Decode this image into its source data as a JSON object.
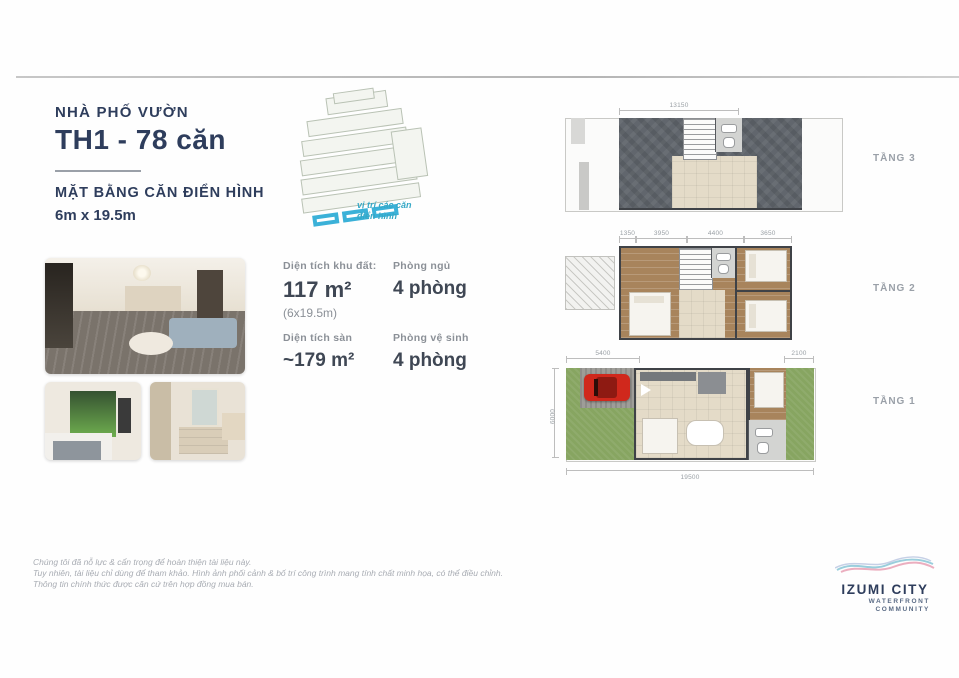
{
  "header": {
    "project_type": "NHÀ PHỐ VƯỜN",
    "unit_title": "TH1 - 78 căn",
    "subtitle": "MẶT BẰNG CĂN ĐIỂN HÌNH",
    "lot_size": "6m x 19.5m"
  },
  "sitemap": {
    "caption_line1": "vị trí các căn",
    "caption_line2": "điển hình"
  },
  "specs": {
    "land_area_label": "Diện tích khu đất:",
    "land_area_value": "117 m²",
    "land_area_note": "(6x19.5m)",
    "bedrooms_label": "Phòng ngủ",
    "bedrooms_value": "4 phòng",
    "floor_area_label": "Diện tích sàn",
    "floor_area_value": "~179 m²",
    "bathrooms_label": "Phòng vệ sinh",
    "bathrooms_value": "4 phòng"
  },
  "floorplans": {
    "floor3": {
      "label": "TẦNG 3",
      "dim_top": "13150"
    },
    "floor2": {
      "label": "TẦNG 2",
      "dims": [
        "1350",
        "3950",
        "4400",
        "3650"
      ]
    },
    "floor1": {
      "label": "TẦNG 1",
      "dim_front": "5400",
      "dim_back": "2100",
      "dim_length": "19500",
      "dim_width": "6000"
    }
  },
  "disclaimer": {
    "line1": "Chúng tôi đã nỗ lực & cẩn trọng để hoàn thiện tài liệu này.",
    "line2": "Tuy nhiên, tài liệu chỉ dùng để tham khảo. Hình ảnh phối cảnh & bố trí công trình mang tính chất minh họa, có thể điều chỉnh.",
    "line3": "Thông tin chính thức được căn cứ trên hợp đồng mua bán."
  },
  "logo": {
    "name": "IZUMI CITY",
    "tagline_line1": "WATERFRONT",
    "tagline_line2": "COMMUNITY"
  },
  "colors": {
    "title_navy": "#2e3d5c",
    "accent_teal": "#35a8c6",
    "highlight_blue": "#3bb1d8",
    "car_red": "#d0281c"
  }
}
